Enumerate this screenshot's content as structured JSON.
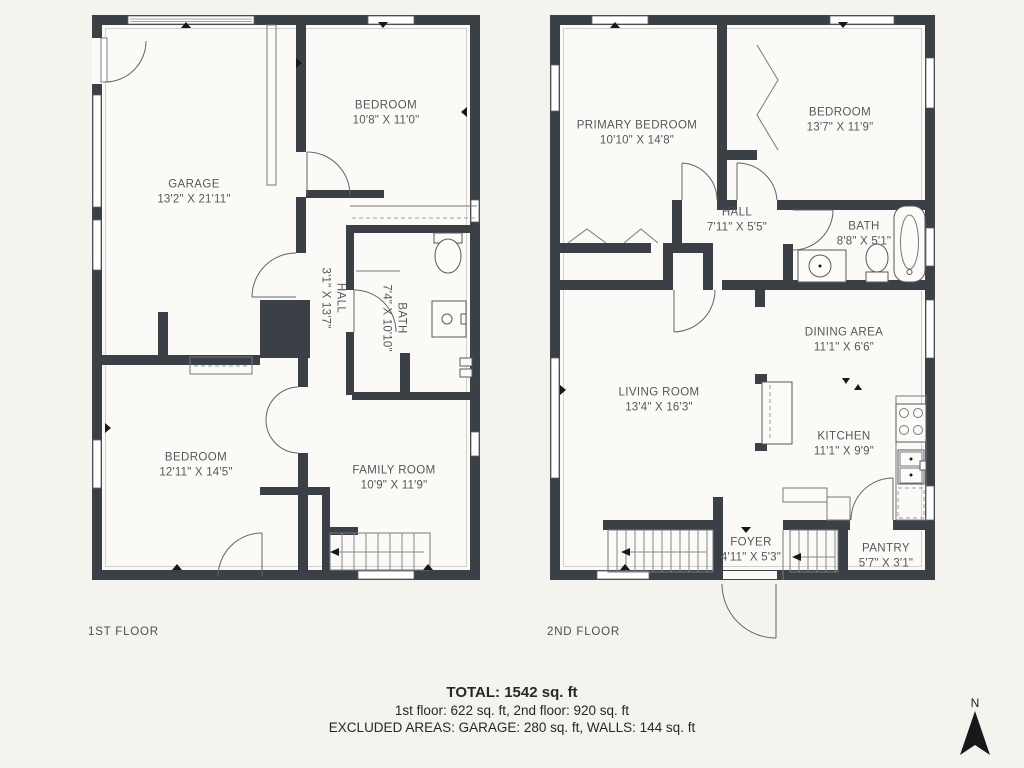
{
  "floor1": {
    "label": "1ST FLOOR",
    "rooms": {
      "garage": {
        "name": "GARAGE",
        "dims": "13'2\" X 21'11\""
      },
      "bedroom_top": {
        "name": "BEDROOM",
        "dims": "10'8\" X 11'0\""
      },
      "hall": {
        "name": "HALL",
        "dims": "3'1\" X 13'7\""
      },
      "bath": {
        "name": "BATH",
        "dims": "7'4\" X 10'10\""
      },
      "bedroom_bottom": {
        "name": "BEDROOM",
        "dims": "12'11\" X 14'5\""
      },
      "family_room": {
        "name": "FAMILY ROOM",
        "dims": "10'9\" X 11'9\""
      }
    }
  },
  "floor2": {
    "label": "2ND FLOOR",
    "rooms": {
      "primary_bedroom": {
        "name": "PRIMARY BEDROOM",
        "dims": "10'10\" X 14'8\""
      },
      "bedroom": {
        "name": "BEDROOM",
        "dims": "13'7\" X 11'9\""
      },
      "hall": {
        "name": "HALL",
        "dims": "7'11\" X 5'5\""
      },
      "bath": {
        "name": "BATH",
        "dims": "8'8\" X 5'1\""
      },
      "dining": {
        "name": "DINING AREA",
        "dims": "11'1\" X 6'6\""
      },
      "living": {
        "name": "LIVING ROOM",
        "dims": "13'4\" X 16'3\""
      },
      "kitchen": {
        "name": "KITCHEN",
        "dims": "11'1\" X 9'9\""
      },
      "foyer": {
        "name": "FOYER",
        "dims": "4'11\" X 5'3\""
      },
      "pantry": {
        "name": "PANTRY",
        "dims": "5'7\" X 3'1\""
      }
    }
  },
  "summary": {
    "total": "TOTAL: 1542 sq. ft",
    "floors": "1st floor: 622 sq. ft, 2nd floor: 920 sq. ft",
    "excluded": "EXCLUDED AREAS: GARAGE: 280 sq. ft, WALLS: 144 sq. ft"
  },
  "compass": {
    "label": "N"
  },
  "colors": {
    "wall": "#3b4046",
    "background": "#f4f3ed",
    "room": "#fbfaf6",
    "text": "#54585b"
  }
}
